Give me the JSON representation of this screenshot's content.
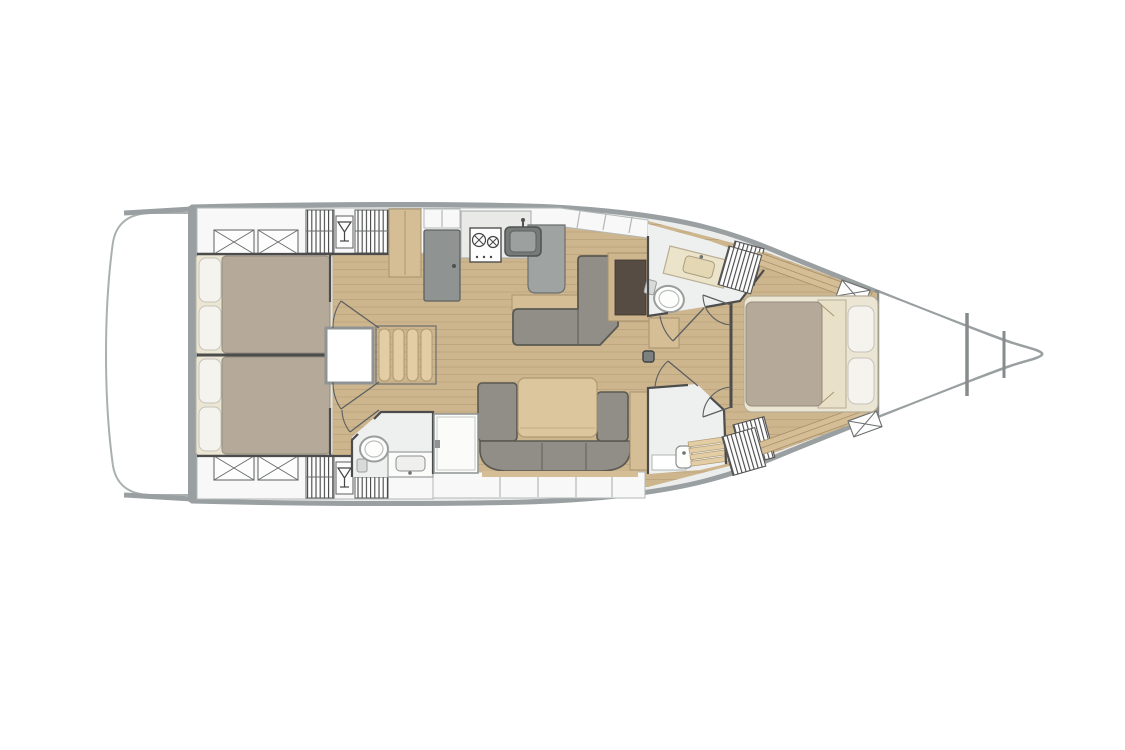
{
  "page": {
    "background": "#ffffff"
  },
  "diagram": {
    "kind": "sailing-yacht-interior-floor-plan",
    "view": "top-down deck plan",
    "orientation": "bow-right-stern-left"
  },
  "colors": {
    "hull-outline": "#9aa0a1",
    "wall": "#4c4c4c",
    "deck-margin": "#eceeed",
    "locker-white": "#f7f8f7",
    "panel-line": "#b4b8b8",
    "wood-floor": "#cdb58e",
    "plank-line": "#b29b74",
    "wood-furniture": "#d5bd95",
    "wood-trim": "#a8926e",
    "steps-wood": "#e2cda4",
    "sofa": "#908e86",
    "sofa-outline": "#5a5951",
    "table-wood": "#dcc69e",
    "duvet": "#b5aa9a",
    "bed-base": "#ebe5d4",
    "pillow": "#f4f3ee",
    "counter-white": "#e9eae8",
    "counter-gray": "#9fa3a2",
    "appliance-gray": "#8f9392",
    "sink-gray": "#767b7a",
    "cream": "#ece3cb",
    "cream-dark": "#e3d7b4",
    "dark-panel": "#564c44",
    "head-floor": "#eef0ef",
    "symbol-dark": "#454545",
    "white": "#ffffff"
  },
  "areas": [
    "swim-platform",
    "aft-cabin-port",
    "aft-cabin-starboard",
    "companionway-steps",
    "engine-hatch",
    "galley",
    "saloon",
    "chart-table",
    "dinette",
    "aft-head",
    "forward-head",
    "forward-shower",
    "owner-cabin",
    "forepeak",
    "mast-step"
  ],
  "icons": [
    "martini-glass-icon",
    "stove-burners-icon",
    "sink-icon",
    "toilet-icon",
    "louvre-vent-icon",
    "cross-hatch-locker-icon",
    "shower-grate-icon"
  ]
}
